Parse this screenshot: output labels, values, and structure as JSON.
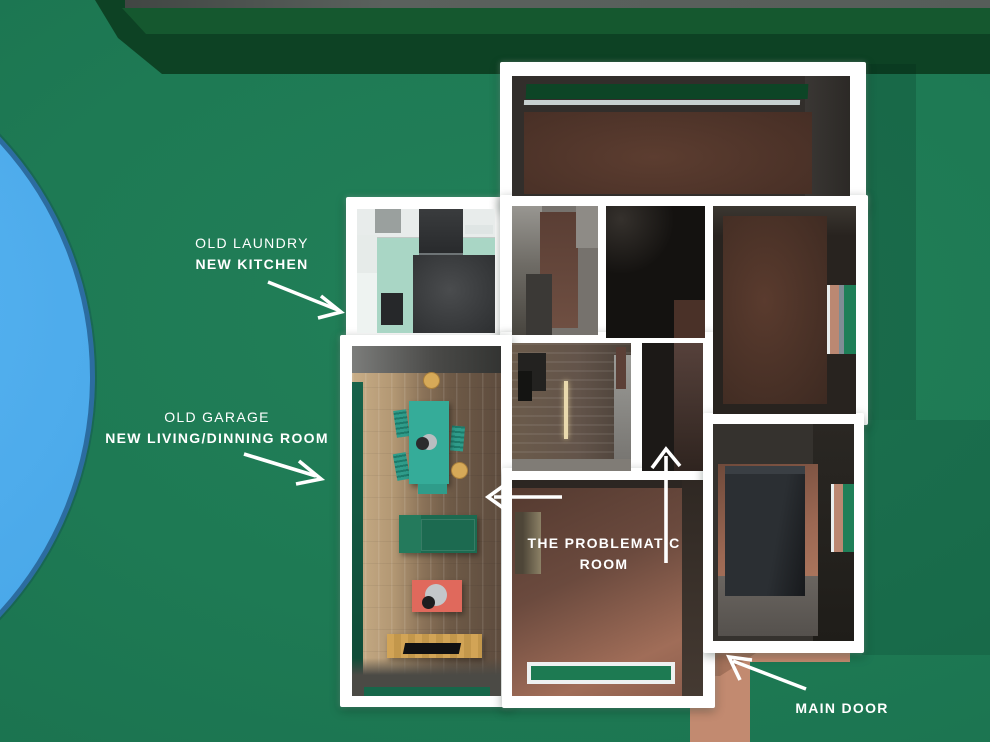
{
  "scene": {
    "description": "Top-down 3D architectural render of a house floor plan on green ground with pool, hedge and entry path",
    "colors": {
      "ground": "#1e7a54",
      "hedge": "#0d4224",
      "pool": "#4fadf0",
      "walls": "#ffffff",
      "path": "#c28a70",
      "kitchen_floor": "#a9d6c5",
      "table_teal": "#35ac99",
      "sofa_green": "#1c6a50",
      "coffee_table_salmon": "#e0695c",
      "tv_bench_wood": "#d2a456",
      "room_brown": "#5a3c2f",
      "text": "#ffffff"
    }
  },
  "annotations": {
    "laundry": {
      "line1": "OLD LAUNDRY",
      "line2": "NEW KITCHEN"
    },
    "garage": {
      "line1": "OLD GARAGE",
      "line2": "NEW LIVING/DINNING ROOM"
    },
    "problematic": {
      "line1": "THE PROBLEMATIC",
      "line2": "ROOM"
    },
    "main_door": {
      "label": "MAIN DOOR"
    }
  }
}
